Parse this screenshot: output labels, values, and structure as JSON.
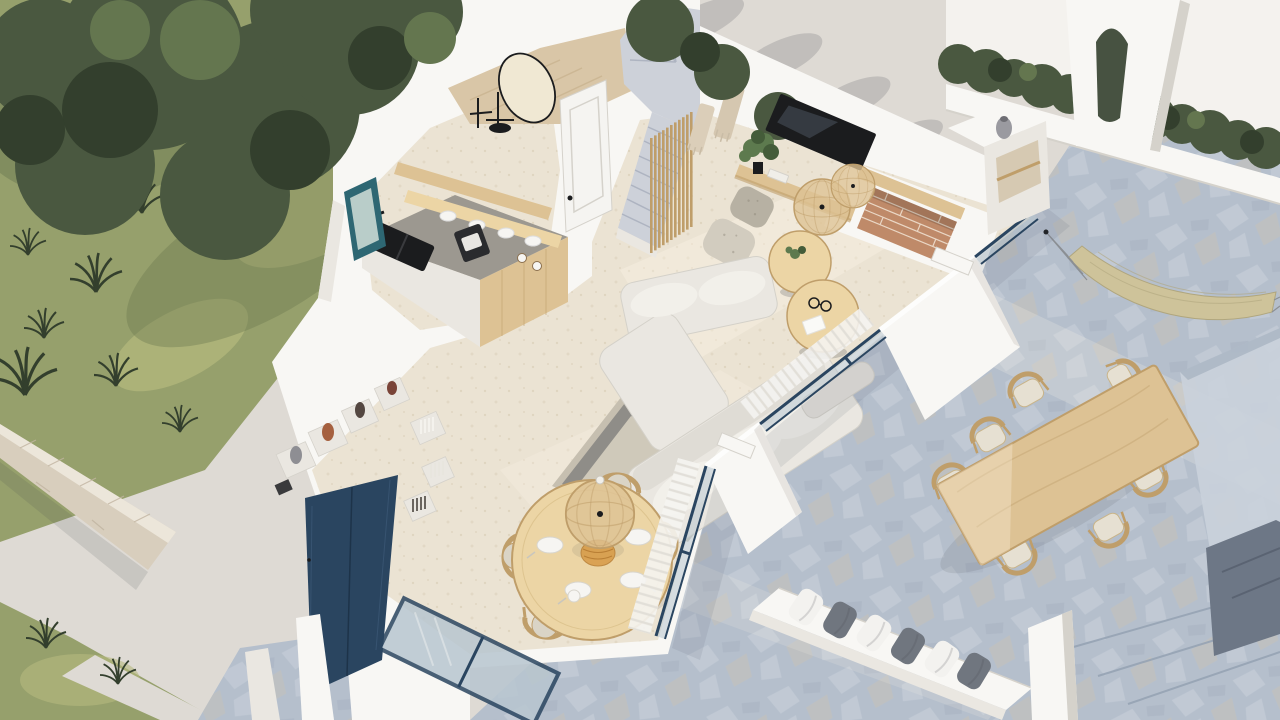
{
  "meta": {
    "description": "High-angle isometric 3D cutaway render of a white Mediterranean villa ground floor: kitchen, powder room, staircase, living room with fireplace, dining area, entry with navy double door, garden with olive tree, and a flagstone terrace with outdoor dining table, hammock and cushion bench.",
    "style": "photorealistic architectural visualization, no visible text"
  },
  "palette": {
    "bg": "#dedad4",
    "grass": "#96a06c",
    "grassL": "#b5b97e",
    "grassD": "#6c7951",
    "fol": "#4a5840",
    "folD": "#333f2d",
    "folL": "#64764f",
    "stoneW": "#d8cebd",
    "stoneWL": "#ece6da",
    "stoneJ": "#c0b4a0",
    "white": "#f8f7f4",
    "whiteSh": "#eae7e1",
    "whiteD": "#d5d2cb",
    "floor": "#ebe3d3",
    "floorD": "#d6c9b2",
    "marble": "#d9c6a7",
    "marbleD": "#bfa882",
    "stair": "#cdd1d9",
    "stairD": "#aeb4c1",
    "terr": "#b5bfcc",
    "terrL": "#cad1db",
    "terrW": "#c8c2b6",
    "terrD": "#96a3b4",
    "pit": "#6d7786",
    "navy": "#2a4560",
    "navyD": "#1d3349",
    "teal": "#2e6773",
    "wood": "#ddc294",
    "woodD": "#bf9e6a",
    "woodL": "#ecd5a5",
    "counter": "#9c9890",
    "black": "#1b1c1e",
    "brick": "#bf8a69",
    "brickL": "#ead7c5",
    "sofa": "#eae7e1",
    "sofaD": "#d4d1c9",
    "cush": "#f2f0ea",
    "rugB": "#8f8d88",
    "rugF": "#cfc9ba",
    "rugF2": "#c6bfb0",
    "pouf": "#b7b1a3",
    "poufL": "#d2ccbf",
    "pillG": "#70767f",
    "pillW": "#f3f2ef",
    "ham": "#cec39a",
    "hamD": "#b0a67e",
    "glass": "#b8c6d0",
    "curt": "#f5f4f1",
    "curtLn": "#e0ddd6",
    "plate": "#f6f5f2",
    "green": "#5d7a4e",
    "greenD": "#445c39",
    "amber": "#d89c49",
    "terra": "#a5603f",
    "vaseD": "#544741",
    "shad": "rgba(60,66,74,0.22)"
  },
  "scene": {
    "garden": {
      "items": [
        "olive-tree",
        "lawn",
        "ornamental-grass-tufts",
        "stone-perimeter-wall",
        "concrete-path"
      ]
    },
    "kitchen": {
      "items": [
        "l-shaped-counter",
        "oak-cabinet-fronts",
        "grey-stone-countertop",
        "black-double-sink",
        "black-faucet",
        "floating-oak-shelves",
        "stacked-plates",
        "espresso-machine",
        "teal-framed-window"
      ]
    },
    "hall": {
      "items": [
        "powder-room-oval-mirror",
        "black-washstand",
        "marble-floor",
        "terrazzo-winder-staircase",
        "oak-slat-screen",
        "white-panel-door",
        "macrame-wall-hangings"
      ]
    },
    "living_room": {
      "items": [
        "wall-mounted-tv",
        "oak-media-shelf",
        "potted-plant",
        "two-rattan-pendant-lamps",
        "brick-fireplace-with-oak-mantel",
        "cream-sectional-sofa",
        "two-organic-oak-coffee-tables",
        "grey-border-area-rug",
        "two-speckled-poufs"
      ],
      "pouf_count": 2,
      "coffee_table_count": 2
    },
    "dining_area": {
      "items": [
        "round-oak-table",
        "wishbone-chairs",
        "white-plates",
        "rattan-dome-pendant",
        "woven-centerpiece",
        "navy-framed-slider-window"
      ],
      "chair_count": 4,
      "plate_count": 4
    },
    "entry": {
      "items": [
        "navy-double-door",
        "built-in-display-niches",
        "clay-vases",
        "book-stacks",
        "flagstone-entry-patio"
      ],
      "niche_vase_count": 4
    },
    "terrace": {
      "items": [
        "blue-grey-flagstone-floor",
        "rectangular-oak-dining-table",
        "outdoor-oak-chairs",
        "woven-hammock",
        "white-cushion-bench",
        "alternating-white-grey-pillows",
        "stone-steps",
        "sunken-stairwell",
        "raised-stone-platform",
        "arched-white-wall",
        "hedge-planter",
        "outdoor-niche-shelf",
        "navy-framed-glass-sliders",
        "sheer-white-curtains"
      ],
      "outdoor_chair_count": 7,
      "bench_pillow_count": 6
    }
  }
}
